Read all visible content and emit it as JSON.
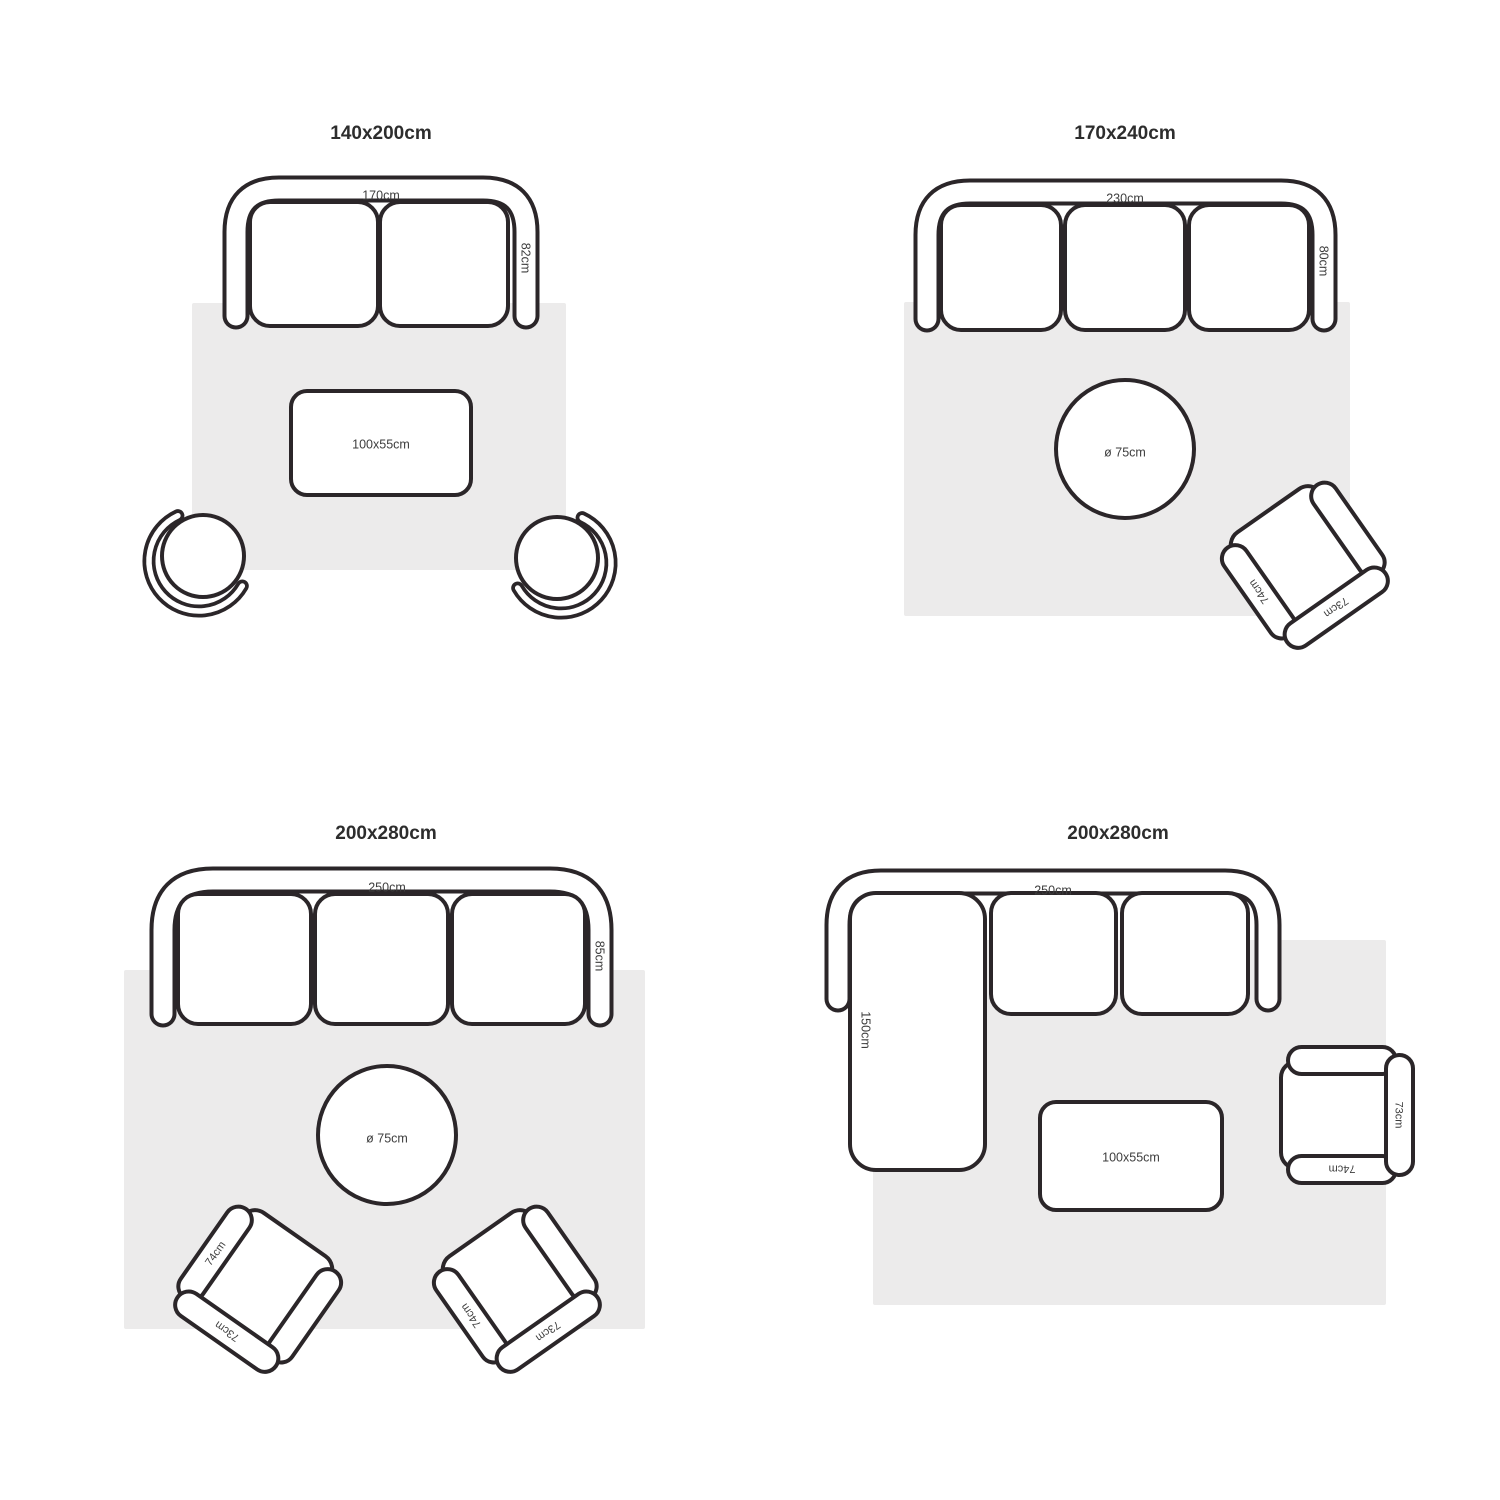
{
  "colors": {
    "line": "#2b2629",
    "rug": "#ECEBEB",
    "label": "#3d3d3d",
    "title": "#2d2d2d",
    "background": "#ffffff"
  },
  "layouts": [
    {
      "title": "140x200cm",
      "sofa_width": "170cm",
      "sofa_depth": "82cm",
      "coffee_table": "100x55cm"
    },
    {
      "title": "170x240cm",
      "sofa_width": "230cm",
      "sofa_depth": "80cm",
      "round_table": "ø 75cm",
      "armchair": {
        "side": "74cm",
        "back": "73cm"
      }
    },
    {
      "title": "200x280cm",
      "sofa_width": "250cm",
      "sofa_depth": "85cm",
      "round_table": "ø 75cm",
      "armchair_left": {
        "side": "74cm",
        "back": "73cm"
      },
      "armchair_right": {
        "side": "74cm",
        "back": "73cm"
      }
    },
    {
      "title": "200x280cm",
      "sofa_width": "250cm",
      "chaise_depth": "150cm",
      "coffee_table": "100x55cm",
      "armchair": {
        "side": "74cm",
        "back": "73cm"
      }
    }
  ]
}
